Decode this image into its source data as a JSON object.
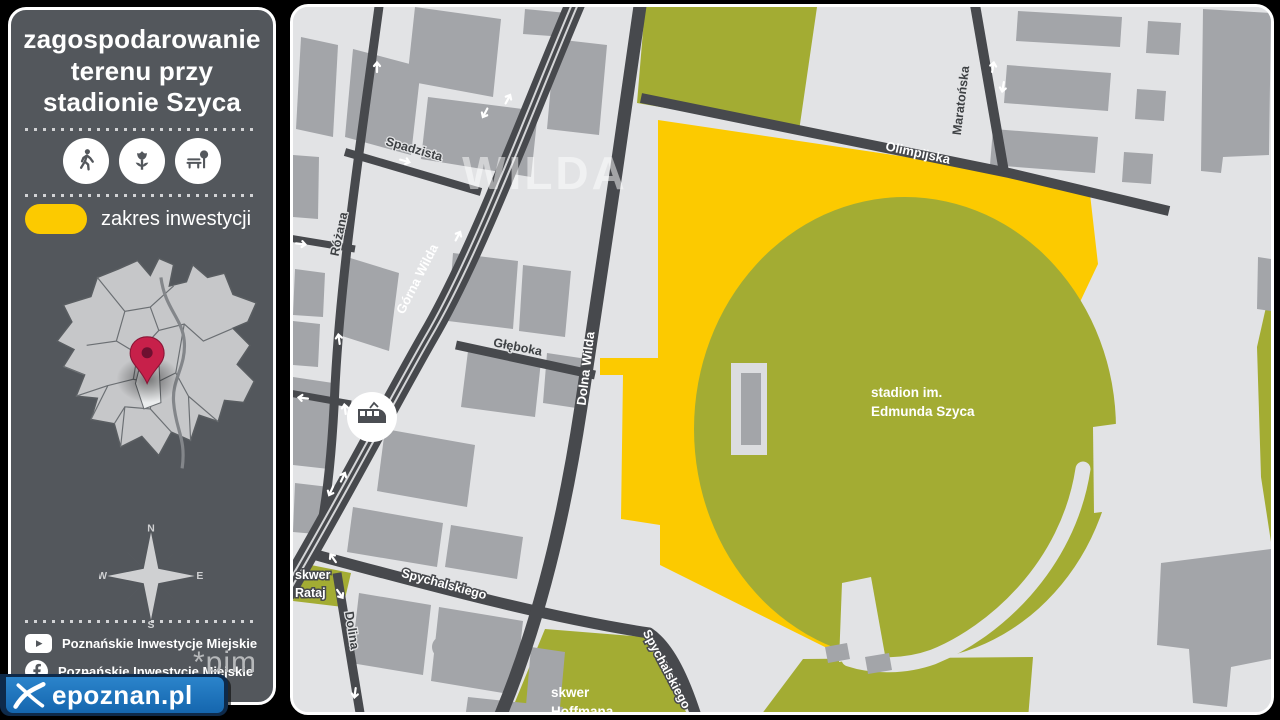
{
  "panel": {
    "title_lines": [
      "zagospodarowanie",
      "terenu przy",
      "stadionie Szyca"
    ],
    "legend": {
      "label": "zakres inwestycji"
    },
    "feature_icons": [
      "pedestrian",
      "greenery",
      "bench-and-tree"
    ],
    "compass": {
      "north": "N",
      "east": "E",
      "south": "S",
      "west": "W"
    },
    "social_rows": [
      {
        "network": "youtube",
        "label": "Poznańskie Inwestycje Miejskie"
      },
      {
        "network": "facebook",
        "label": "Poznańskie Inwestycje Miejskie"
      }
    ],
    "pim_logo_text": "*pim"
  },
  "watermark": {
    "text": "epoznan.pl"
  },
  "map": {
    "district_label": "WILDA",
    "stadium_label_lines": [
      "stadion im.",
      "Edmunda Szyca"
    ],
    "streets": {
      "spadzista": "Spadzista",
      "rozana": "Różana",
      "gorna_wilda": "Górna Wilda",
      "gleboka": "Głęboka",
      "dolna_wilda": "Dolna Wilda",
      "olimpijska": "Olimpijska",
      "maratonska": "Maratońska",
      "spychalskiego": "Spychalskiego",
      "spychalskiego2": "Spychalskiego",
      "dolina": "Dolina"
    },
    "areas": {
      "skwer_rataj_lines": [
        "skwer",
        "Rataj"
      ],
      "skwer_hoffmana_lines": [
        "skwer",
        "Hoffmana"
      ]
    }
  },
  "colors": {
    "investment_yellow": "#fcca00",
    "green_area": "#a3ac33",
    "road": "#47494d",
    "building": "#a3a5a9",
    "map_background": "#e2e3e5",
    "panel_background": "#53575c",
    "pin_red": "#c7204a",
    "epoznan_blue": "#1a6db6"
  }
}
